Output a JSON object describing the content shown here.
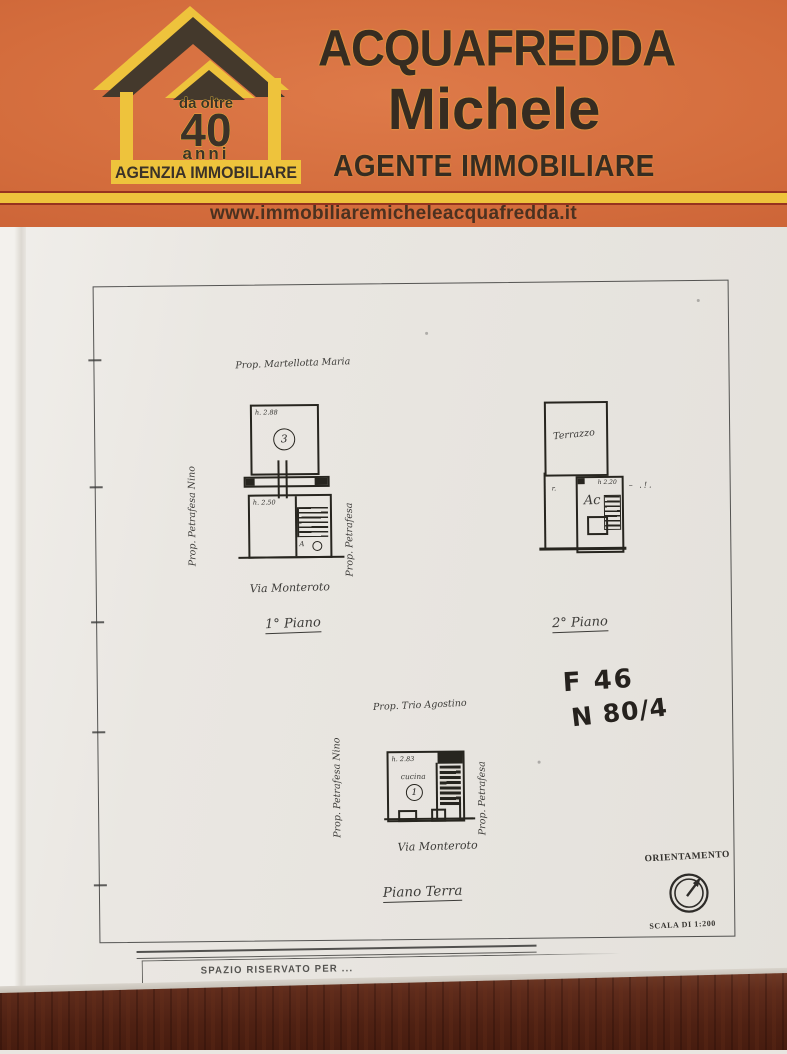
{
  "banner": {
    "logo": {
      "tagline_top": "da oltre",
      "tagline_number": "40",
      "tagline_bottom": "anni",
      "bar_label": "AGENZIA IMMOBILIARE"
    },
    "name_line1": "ACQUAFREDDA",
    "name_line2": "Michele",
    "role": "AGENTE IMMOBILIARE",
    "website": "www.immobiliaremicheleacquafredda.it"
  },
  "document": {
    "first_floor": {
      "owner_top": "Prop. Martellotta Maria",
      "owner_left": "Prop. Petrafesa Nino",
      "owner_right": "Prop. Petrafesa",
      "height_upper_room": "h. 2.88",
      "room_number_upper": "3",
      "height_lower_room": "h. 2.50",
      "wc_label": "A",
      "street": "Via Monteroto",
      "caption": "1° Piano"
    },
    "second_floor": {
      "terrace_label": "Terrazzo",
      "room_label": "Ac",
      "height_note": "h 2.20",
      "caption": "2° Piano"
    },
    "ground_floor": {
      "owner_top": "Prop. Trio Agostino",
      "owner_left": "Prop. Petrafesa Nino",
      "owner_right": "Prop. Petrafesa",
      "height_note": "h. 2.83",
      "room_label": "cucina",
      "room_number": "1",
      "street": "Via Monteroto",
      "caption": "Piano Terra"
    },
    "cadastral_note": {
      "line1": "F 46",
      "line2": "N 80/4"
    },
    "orientation": {
      "label": "ORIENTAMENTO",
      "scale": "SCALA DI 1:200"
    },
    "footer_strip_label": "SPAZIO RISERVATO PER ..."
  },
  "colors": {
    "banner_orange": "#cf6436",
    "banner_yellow": "#eec33c",
    "banner_text_dark": "#362c21",
    "paper": "#e9e6e1",
    "ink": "#2b2a28",
    "table_wood": "#522416"
  }
}
